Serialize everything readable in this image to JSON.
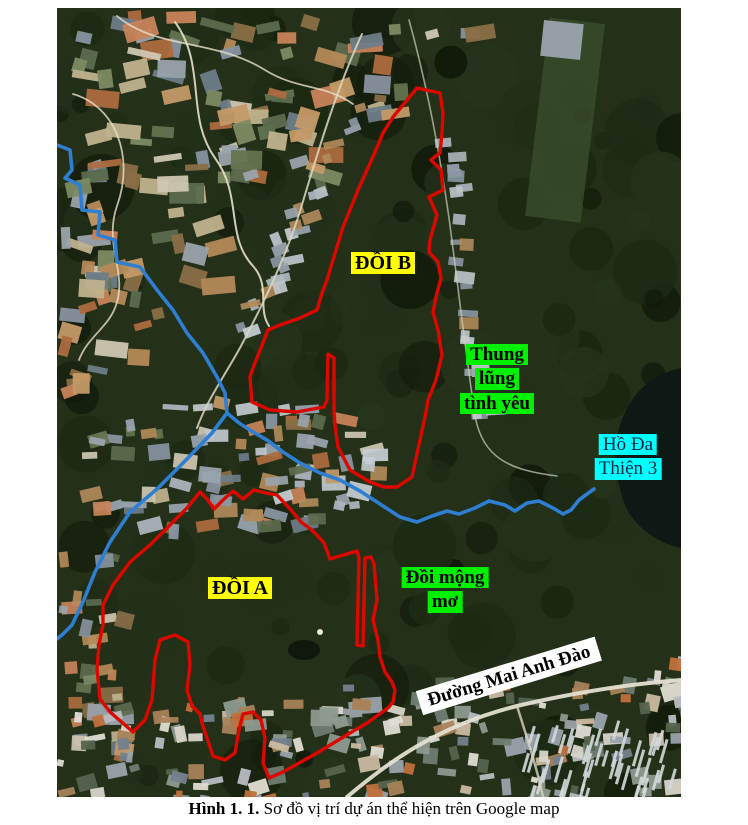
{
  "figure": {
    "caption": {
      "number": "Hình 1. 1.",
      "text": " Sơ đồ vị trí dự án thể hiện trên Google map"
    },
    "map": {
      "labels": {
        "hill_b": "ĐỒI B",
        "hill_a": "ĐỒI A",
        "valley_lines": [
          "Thung",
          "lũng",
          "tình yêu"
        ],
        "lake_lines": [
          "Hồ Đa",
          "Thiện 3"
        ],
        "mongmo_lines": [
          "Đồi mộng",
          "mơ"
        ],
        "road": "Đường Mai Anh Đào"
      },
      "colors": {
        "boundary_red": "#dc0800",
        "stream_blue": "#2e7fd2",
        "hill_label_bg": "#ffff00",
        "green_label_bg": "#00f000",
        "lake_label_bg": "#00ffff",
        "lake_label_text": "#0a2540",
        "road_label_bg": "#ffffff",
        "label_text": "#000000"
      }
    }
  }
}
